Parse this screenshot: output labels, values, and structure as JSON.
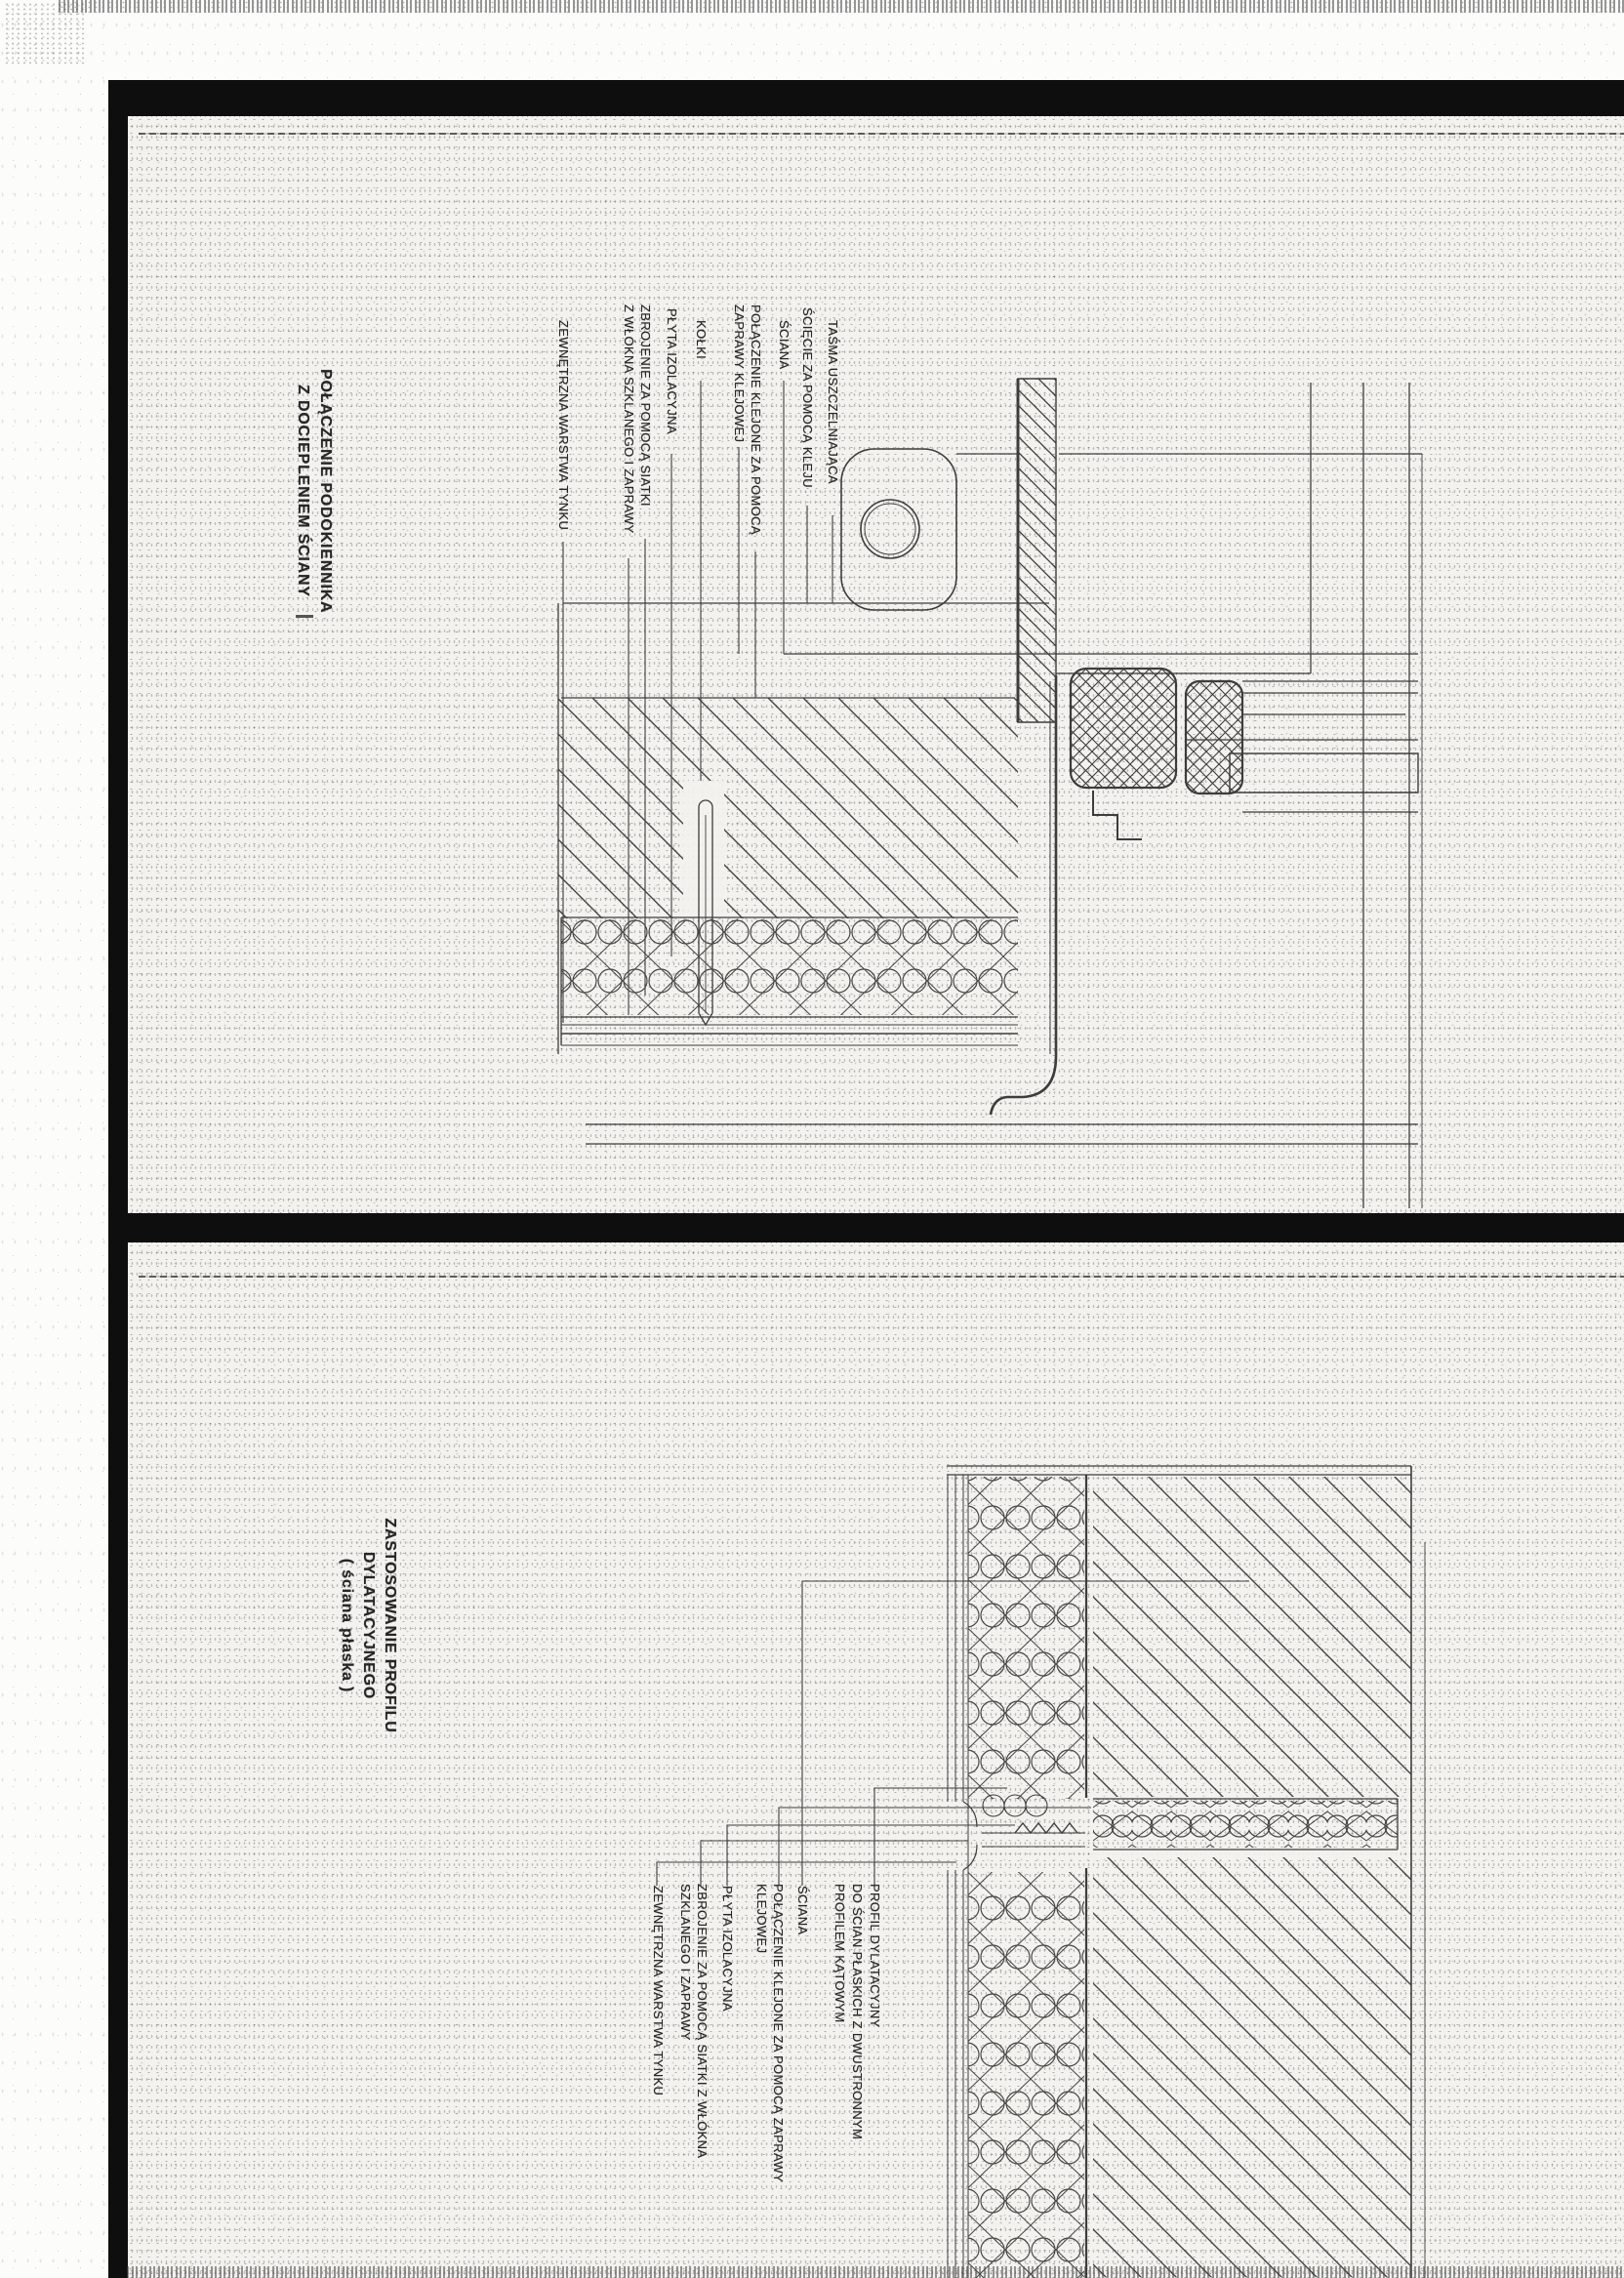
{
  "colors": {
    "paper": "#f3f2ee",
    "ink": "#2e2e2e",
    "bar": "#0e0e0e"
  },
  "page1": {
    "title_lines": [
      "POŁĄCZENIE PODOKIENNIKA",
      "Z DOCIEPLENIEM ŚCIANY"
    ],
    "callouts": [
      {
        "label": "TAŚMA USZCZELNIAJĄCA"
      },
      {
        "label": "ŚCIĘCIE ZA POMOCĄ KLEJU"
      },
      {
        "label": "ŚCIANA"
      },
      {
        "label": "POŁĄCZENIE KLEJONE ZA POMOCĄ"
      },
      {
        "label": "ZAPRAWY KLEJOWEJ"
      },
      {
        "label": "KOŁKI"
      },
      {
        "label": "PŁYTA IZOLACYJNA"
      },
      {
        "label": "ZBROJENIE ZA POMOCĄ SIATKI"
      },
      {
        "label": "Z WŁÓKNA SZKLANEGO I ZAPRAWY"
      },
      {
        "label": "ZEWNĘTRZNA WARSTWA TYNKU"
      }
    ]
  },
  "page2": {
    "title_lines": [
      "ZASTOSOWANIE PROFILU",
      "DYLATACYJNEGO",
      "( ściana płaska )"
    ],
    "callouts": [
      {
        "label": "PROFIL DYLATACYJNY"
      },
      {
        "label": "DO ŚCIAN PŁASKICH Z DWUSTRONNYM"
      },
      {
        "label": "PROFILEM KĄTOWYM"
      },
      {
        "label": "ŚCIANA"
      },
      {
        "label": "POŁĄCZENIE KLEJONE ZA POMOCĄ ZAPRAWY"
      },
      {
        "label": "KLEJOWEJ"
      },
      {
        "label": "PŁYTA IZOLACYJNA"
      },
      {
        "label": "ZBROJENIE ZA POMOCĄ SIATKI Z WŁÓKNA"
      },
      {
        "label": "SZKLANEGO I ZAPRAWY"
      },
      {
        "label": "ZEWNĘTRZNA WARSTWA TYNKU"
      }
    ]
  }
}
